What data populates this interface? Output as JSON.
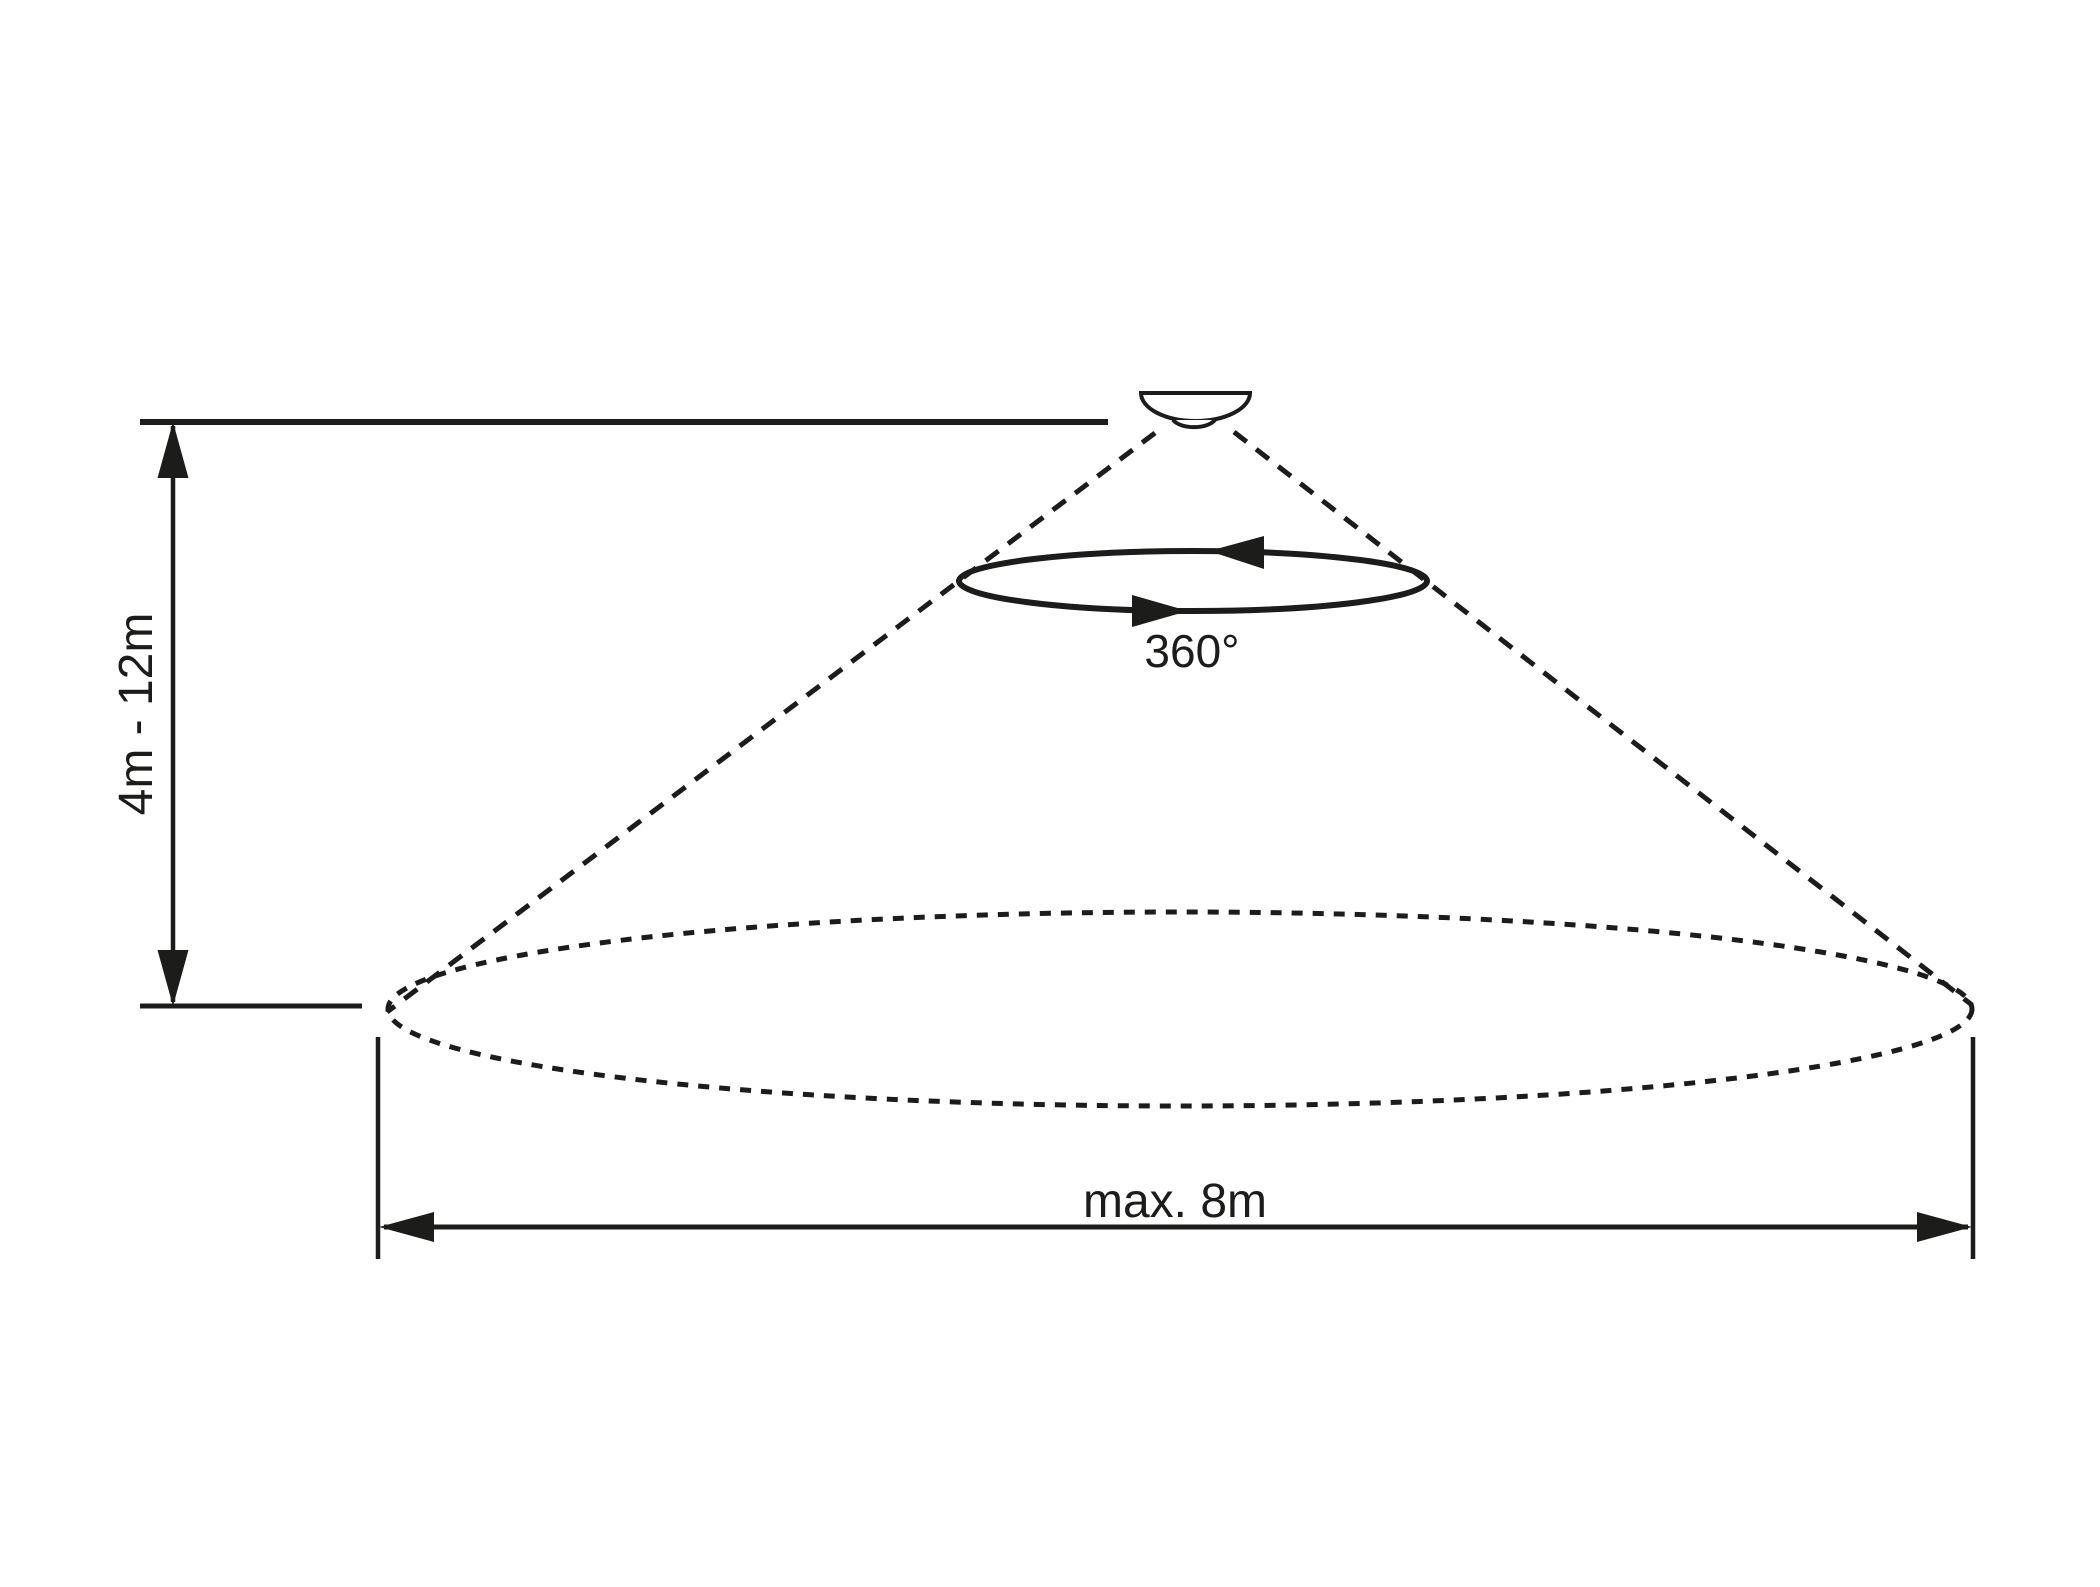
{
  "diagram": {
    "colors": {
      "ink": "#1c1c1a",
      "background": "#ffffff"
    },
    "labels": {
      "mounting_height": "4m - 12m",
      "rotation_angle": "360°",
      "coverage_diameter": "max. 8m"
    }
  }
}
